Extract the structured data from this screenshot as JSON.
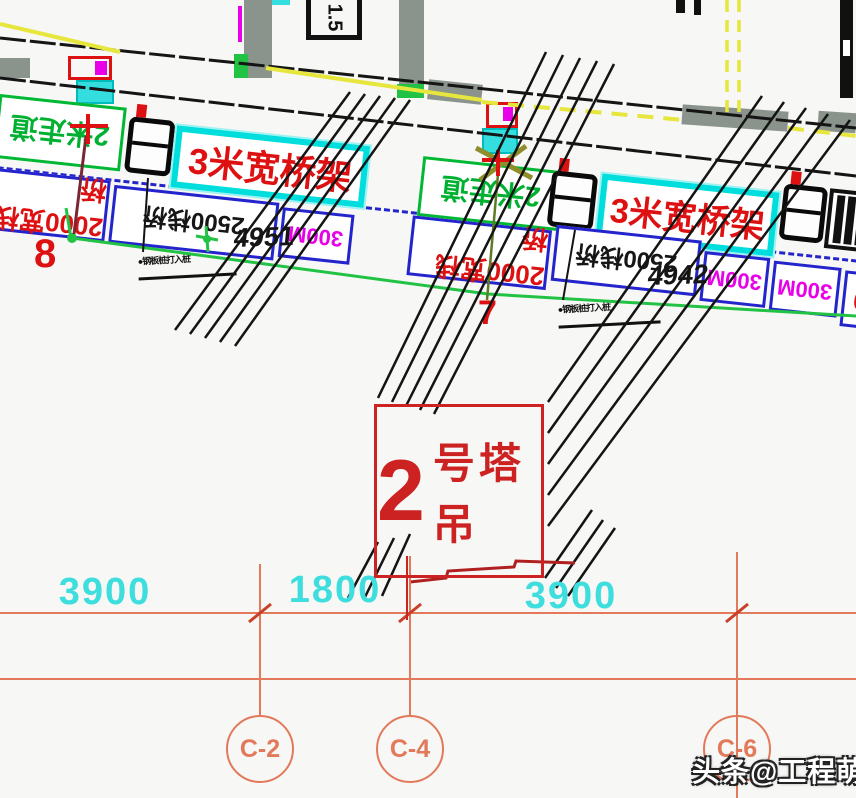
{
  "colors": {
    "accent_red": "#cc2222",
    "deck_cyan": "#00dddd",
    "walkway_green": "#00b833",
    "trestle_blue": "#2424cc",
    "magenta": "#e800e8",
    "dim_cyan": "#3fdede",
    "axis_salmon": "#e2795b",
    "yellow": "#e6e63c",
    "wall_gray": "#8b948c",
    "line_black": "#141414"
  },
  "top_box": {
    "label": "1.5"
  },
  "band": {
    "walkways": [
      {
        "label": "2米走道"
      },
      {
        "label": "2米走道"
      },
      {
        "label": "2米走道"
      }
    ],
    "decks": [
      {
        "label": "3米宽桥架"
      },
      {
        "label": "3米宽桥架"
      }
    ],
    "trestles": [
      {
        "label": "2000宽栈桥"
      },
      {
        "label": "2500栈桥"
      },
      {
        "label": "300M"
      },
      {
        "label": "2000宽栈桥"
      },
      {
        "label": "2500栈桥"
      },
      {
        "label": "300M"
      },
      {
        "label": "300M"
      },
      {
        "label": "2000"
      }
    ],
    "segment_dims": [
      "4951",
      "4942"
    ],
    "pile_notes": [
      {
        "label": "●钢板桩打入桩"
      },
      {
        "label": "●钢板桩打入桩"
      }
    ]
  },
  "crane": {
    "number": "2",
    "suffix": "号塔吊"
  },
  "axes": {
    "row_labels": [
      "8",
      "7"
    ],
    "dims": [
      "3900",
      "1800",
      "3900"
    ],
    "bubbles": [
      "C-2",
      "C-4",
      "C-6"
    ]
  },
  "watermark": {
    "text": "头条@工程萌主"
  }
}
